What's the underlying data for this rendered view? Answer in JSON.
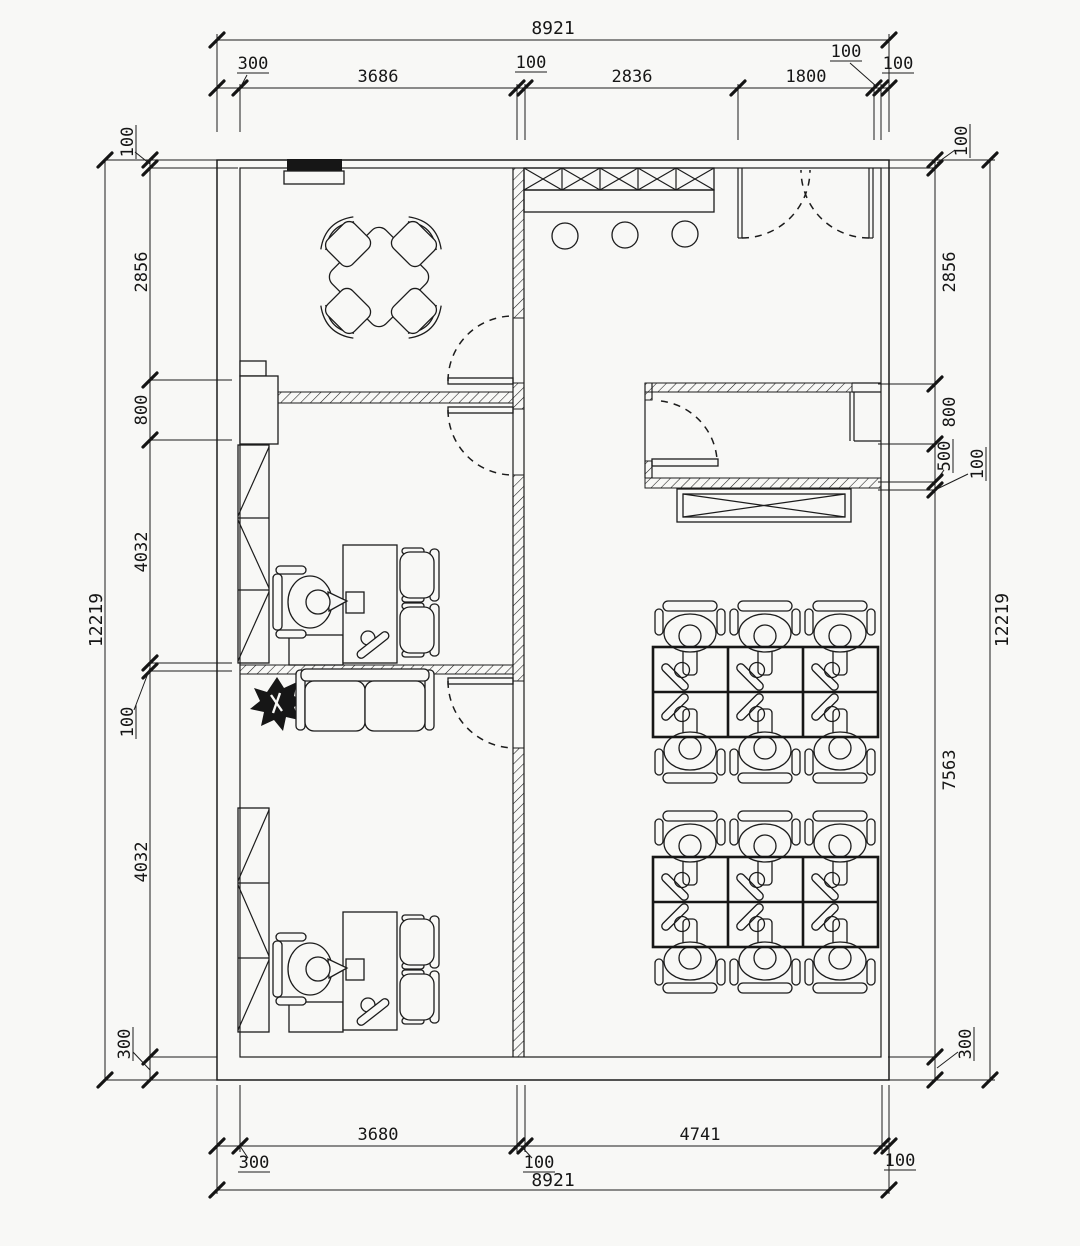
{
  "palette": {
    "paper": "#f8f8f6",
    "ink": "#1c1c1c"
  },
  "dims": {
    "top": {
      "overall": "8921",
      "chain": [
        "300",
        "3686",
        "100",
        "2836",
        "1800",
        "100",
        "100"
      ]
    },
    "bottom": {
      "overall": "8921",
      "chain": [
        "300",
        "3680",
        "100",
        "4741",
        "100"
      ]
    },
    "left": {
      "overall": "12219",
      "chain": [
        "100",
        "2856",
        "800",
        "4032",
        "100",
        "4032",
        "300"
      ]
    },
    "right": {
      "overall": "12219",
      "chain": [
        "100",
        "2856",
        "800",
        "500",
        "100",
        "7563",
        "300"
      ]
    }
  },
  "furniture": {
    "meeting_chairs": 4,
    "meeting_tables": 1,
    "bar_stools": 3,
    "workstations": 12,
    "private_desk_sets": 2,
    "guest_chairs": 4,
    "bookcases": 2,
    "sofas": 1,
    "plants": 1,
    "crossed_cabinets": 1,
    "tv_units": 1,
    "double_entry_doors": 1,
    "single_doors": 4
  }
}
